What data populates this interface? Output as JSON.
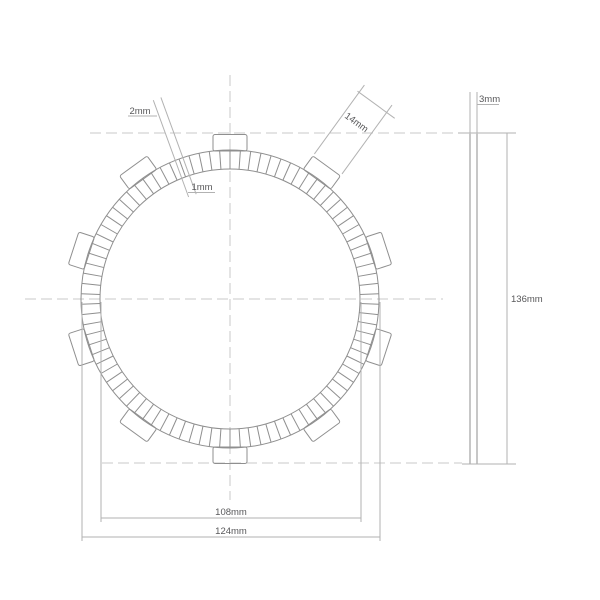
{
  "background": "#ffffff",
  "colors": {
    "geometry_line": "#8f8f8f",
    "dimension_line": "#b2b2b2",
    "centerline": "#c9c9c9",
    "text": "#58585a"
  },
  "dimensions": {
    "groove_width_outer": {
      "label": "2mm",
      "mm": 2
    },
    "groove_width_inner": {
      "label": "1mm",
      "mm": 1
    },
    "tab_width": {
      "label": "14mm",
      "mm": 14
    },
    "thickness": {
      "label": "3mm",
      "mm": 3
    },
    "overall_diameter": {
      "label": "136mm",
      "mm": 136
    },
    "inner_diameter": {
      "label": "108mm",
      "mm": 108
    },
    "outer_diameter": {
      "label": "124mm",
      "mm": 124
    }
  },
  "geometry": {
    "front_view": {
      "cx": 230,
      "cy": 299,
      "r_outer": 149,
      "r_inner": 130,
      "tab_mid_r": 156.25,
      "tab_count": 10,
      "tab_start_angle_deg": 90,
      "tab_width_px": 34,
      "tab_height_px": 16.5,
      "groove_count": 90,
      "groove_step_deg": 4
    },
    "side_view": {
      "x": 470,
      "width": 7,
      "y_top": 133,
      "y_bottom": 464
    },
    "centerlines": [
      {
        "name": "vertical-centerline",
        "x1": 230,
        "y1": 75,
        "x2": 230,
        "y2": 500
      },
      {
        "name": "top-centerline",
        "x1": 90,
        "y1": 133,
        "x2": 456,
        "y2": 133
      },
      {
        "name": "middle-centerline",
        "x1": 25,
        "y1": 299,
        "x2": 443,
        "y2": 299
      },
      {
        "name": "bottom-centerline",
        "x1": 102,
        "y1": 463,
        "x2": 462,
        "y2": 463
      }
    ]
  }
}
